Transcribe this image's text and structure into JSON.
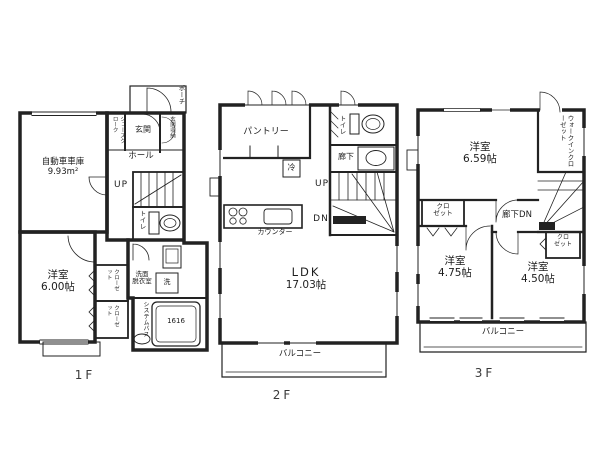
{
  "colors": {
    "line": "#222222",
    "background": "#ffffff"
  },
  "floors": {
    "f1": {
      "floor_label": "1F",
      "porch": "ポーチ",
      "shoe_closet": "シューズクローク",
      "entrance": "玄関",
      "entrance_storage": "玄関収納",
      "hall": "ホール",
      "stairs_up": "UP",
      "toilet": "トイレ",
      "garage": {
        "name": "自動車車庫",
        "area": "9.93m²"
      },
      "bedroom": {
        "name": "洋室",
        "area": "6.00帖"
      },
      "closet_a": "クローゼット",
      "closet_b": "クローゼット",
      "washroom": [
        "洗面",
        "脱衣室"
      ],
      "washer": "洗",
      "bath": {
        "name": "システムバス",
        "size": "1616"
      }
    },
    "f2": {
      "floor_label": "2F",
      "pantry": "パントリー",
      "toilet": "トイレ",
      "corridor": "廊下",
      "fridge": "冷",
      "stairs_up": "UP",
      "stairs_down": "DN",
      "counter": "カウンター",
      "ldk": {
        "name": "LDK",
        "area": "17.03帖"
      },
      "balcony": "バルコニー"
    },
    "f3": {
      "floor_label": "3F",
      "bedroom_a": {
        "name": "洋室",
        "area": "6.59帖"
      },
      "walk_in_closet": "ウォークインクローゼット",
      "closet_a": [
        "クロ",
        "ゼット"
      ],
      "corridor_down": "廊下DN",
      "bedroom_b": {
        "name": "洋室",
        "area": "4.75帖"
      },
      "bedroom_c": {
        "name": "洋室",
        "area": "4.50帖"
      },
      "closet_b": [
        "クロ",
        "ゼット"
      ],
      "balcony": "バルコニー"
    }
  }
}
